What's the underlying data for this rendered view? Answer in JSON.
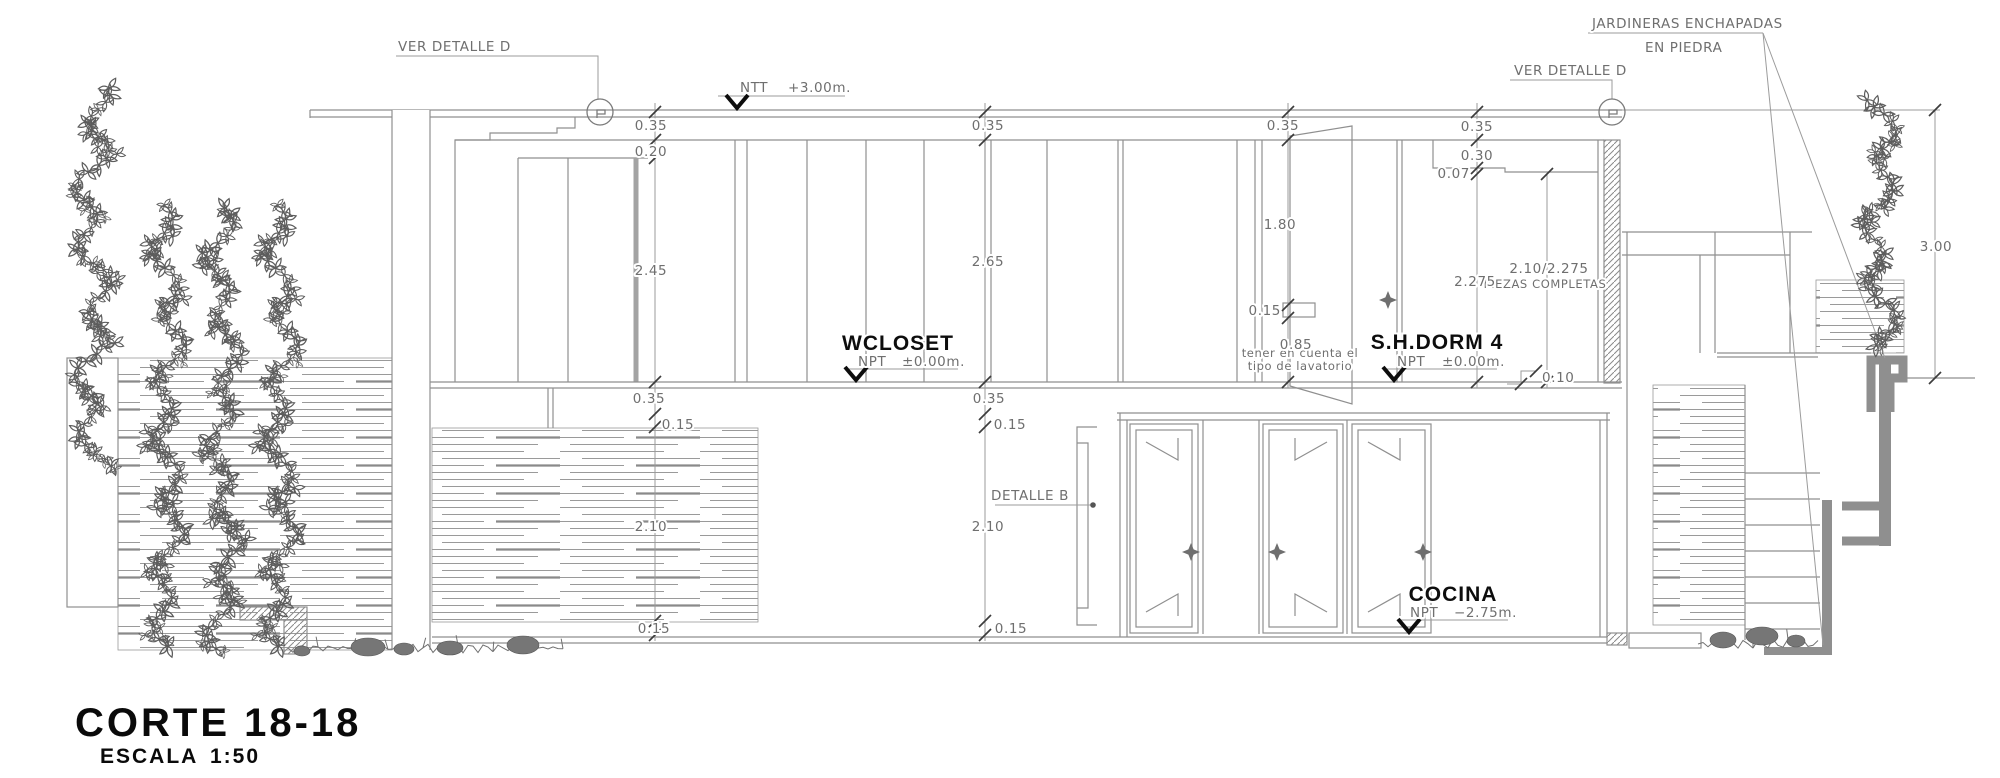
{
  "drawing": {
    "title": "CORTE 18-18",
    "scale_label": "ESCALA",
    "scale_value": "1:50"
  },
  "callouts": {
    "ver_detalle_left": "VER DETALLE D",
    "ver_detalle_right": "VER DETALLE D",
    "jardineras_line1": "JARDINERAS ENCHAPADAS",
    "jardineras_line2": "EN PIEDRA",
    "detalle_b": "DETALLE B",
    "lavatorio_line1": "tener en cuenta el",
    "lavatorio_line2": "tipo de lavatorio",
    "piezas_line1": "2.10/2.275",
    "piezas_line2": "PIEZAS COMPLETAS"
  },
  "levels": {
    "ntt": {
      "label": "NTT",
      "value": "+3.00m."
    },
    "wcloset": {
      "room": "WCLOSET",
      "label": "NPT",
      "value": "±0.00m."
    },
    "shdorm4": {
      "room": "S.H.DORM 4",
      "label": "NPT",
      "value": "±0.00m."
    },
    "cocina": {
      "room": "COCINA",
      "label": "NPT",
      "value": "−2.75m."
    }
  },
  "dims": {
    "chain_left": [
      "0.35",
      "0.20",
      "2.45",
      "0.35",
      "0.15",
      "2.10",
      "0.15"
    ],
    "chain_mid": [
      "0.35",
      "2.65",
      "0.35",
      "0.15",
      "2.10",
      "0.15"
    ],
    "chain_bath": [
      "0.35",
      "1.80",
      "0.15",
      "0.85"
    ],
    "chain_right": [
      "0.35",
      "0.30",
      "0.07",
      "2.275"
    ],
    "step": "0.10",
    "garden_wall_height": "3.00"
  },
  "colors": {
    "line": "#8f8f8f",
    "dim_text": "#6f6f6f",
    "label_black": "#111111",
    "planter_gray": "#8f8f8f",
    "foliage": "#5d5d5d"
  }
}
